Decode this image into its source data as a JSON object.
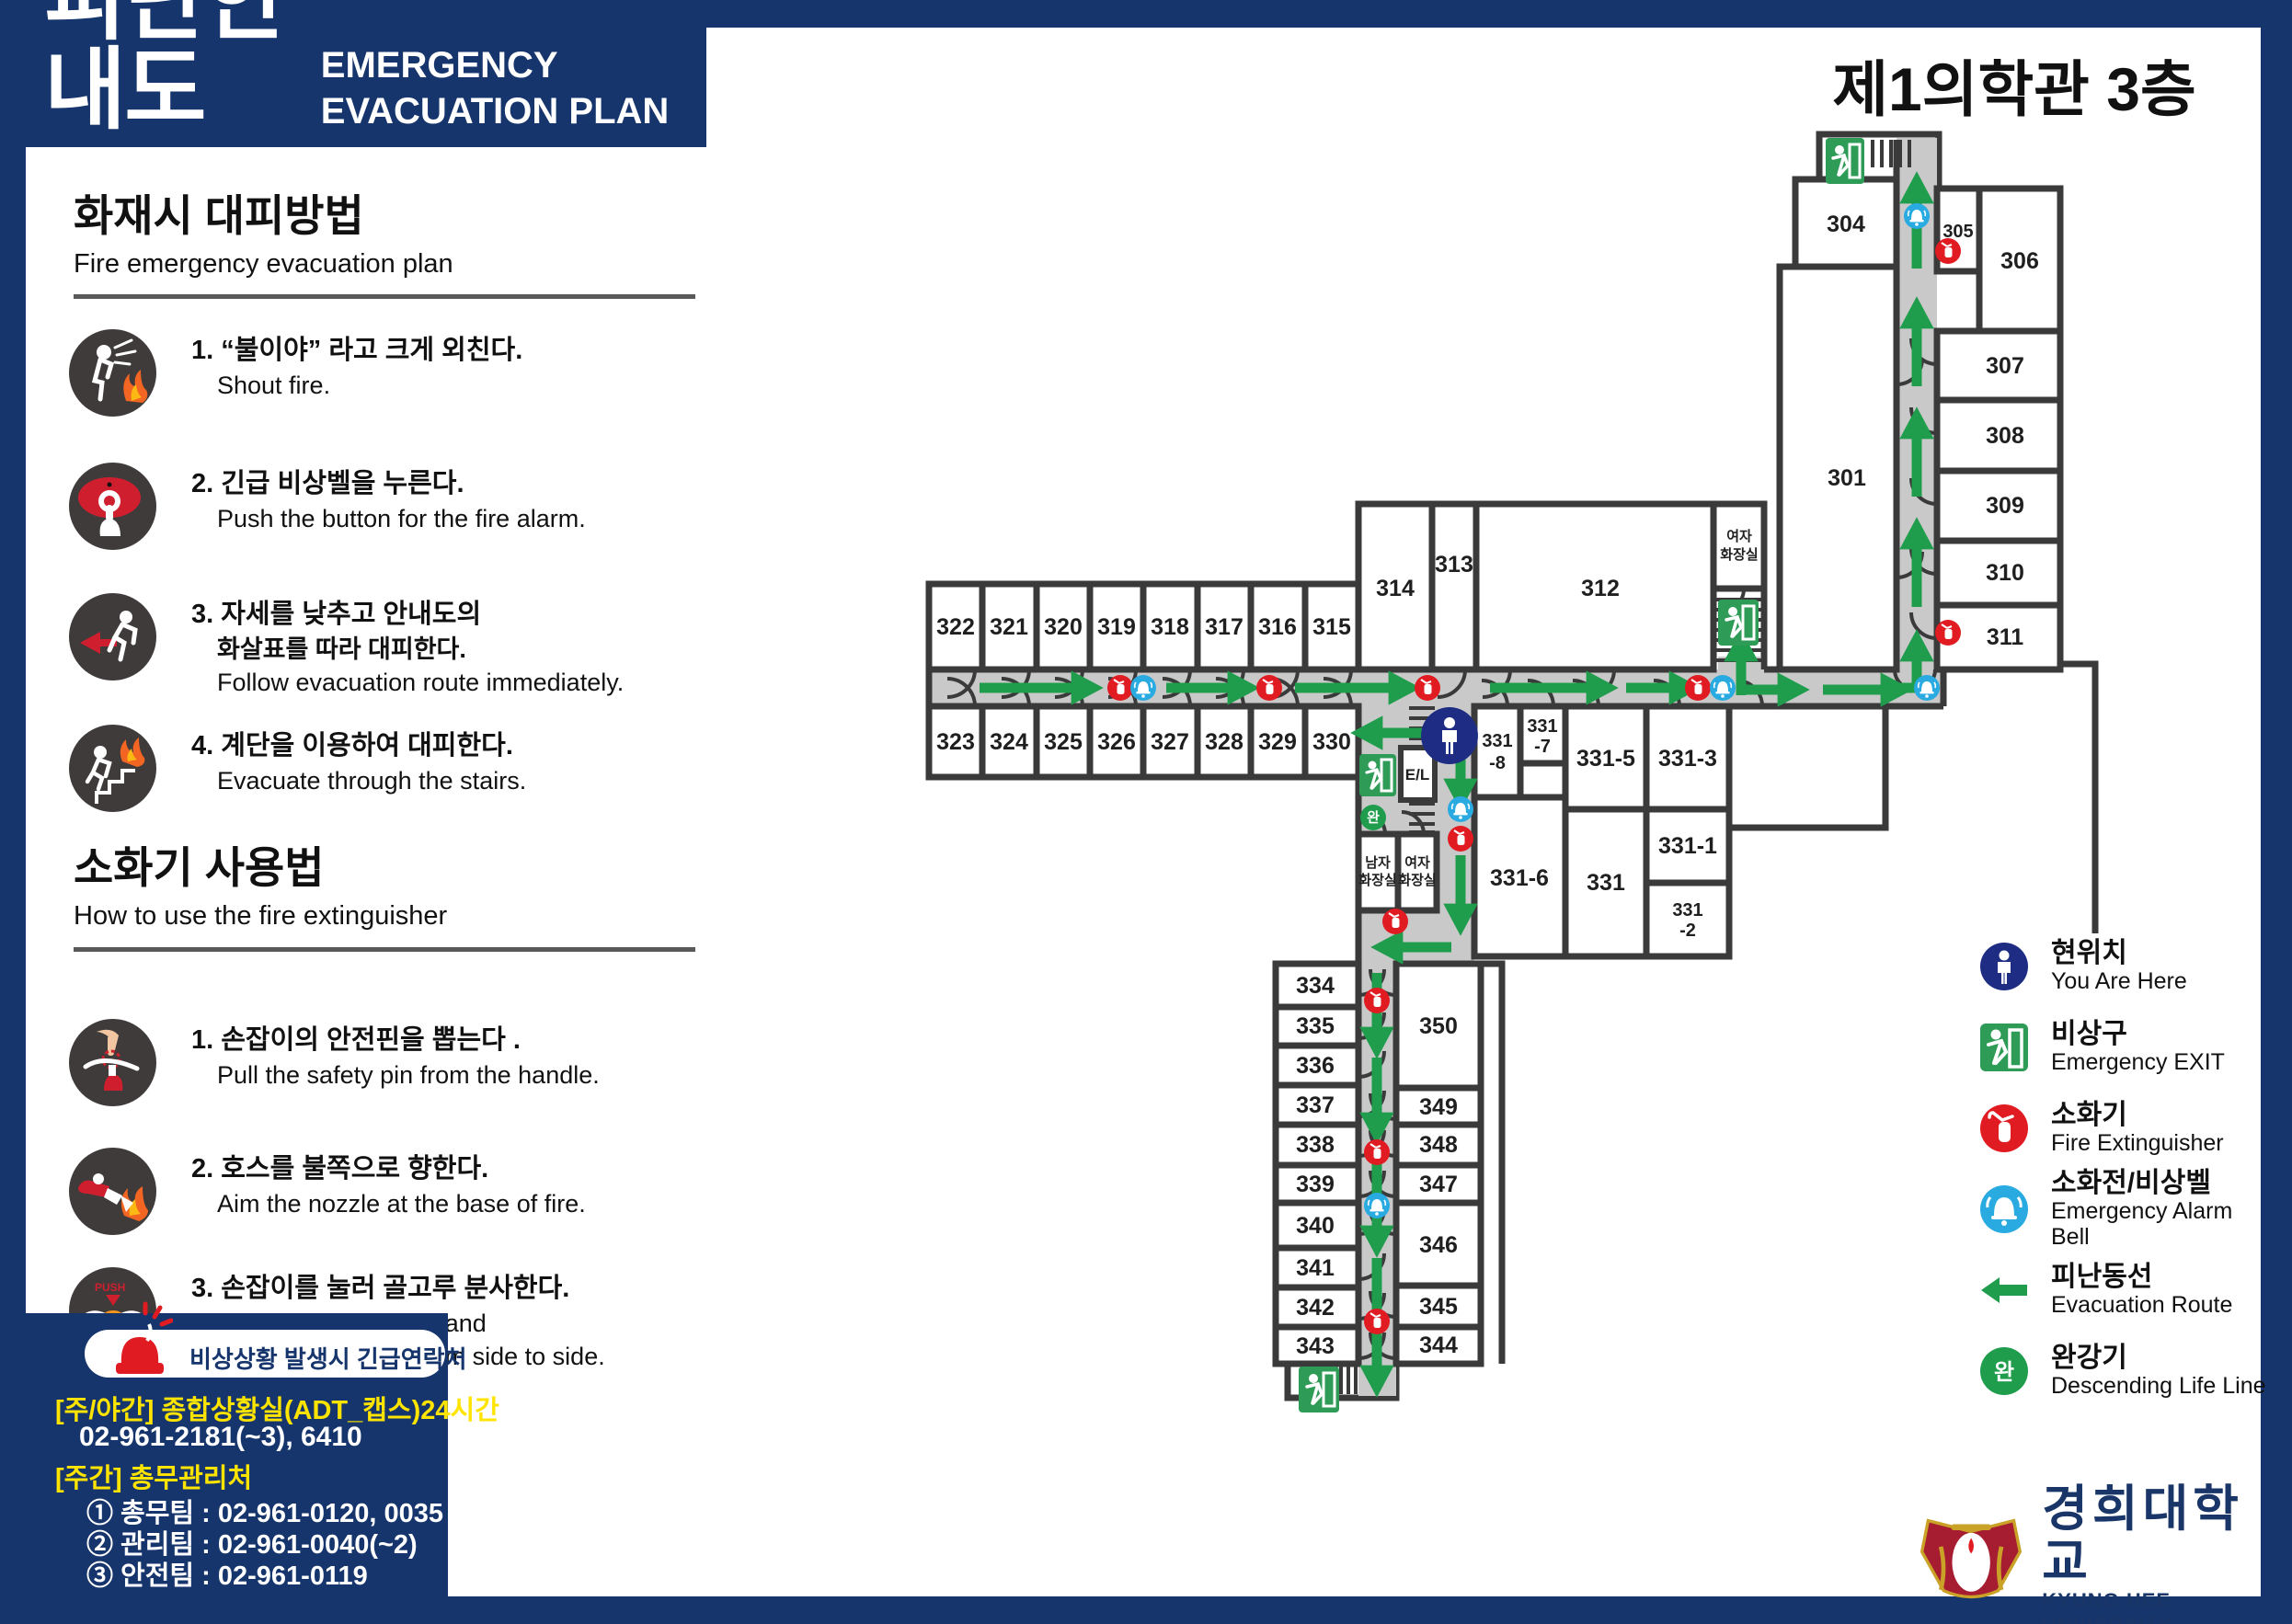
{
  "header": {
    "title_ko": "피난안내도",
    "title_en": "EMERGENCY EVACUATION PLAN",
    "building": "제1의학관 3층"
  },
  "fire_evacuation": {
    "title_ko": "화재시 대피방법",
    "title_en": "Fire emergency evacuation plan",
    "steps": [
      {
        "ko": "1. “불이야” 라고 크게 외친다.",
        "en": "Shout fire."
      },
      {
        "ko": "2. 긴급 비상벨을 누른다.",
        "en": "Push the button for the fire alarm."
      },
      {
        "ko": "3. 자세를 낮추고 안내도의",
        "ko2": "화살표를 따라 대피한다.",
        "en": "Follow evacuation route immediately."
      },
      {
        "ko": "4. 계단을 이용하여 대피한다.",
        "en": "Evacuate through the stairs."
      }
    ]
  },
  "extinguisher_usage": {
    "title_ko": "소화기 사용법",
    "title_en": "How to use the fire extinguisher",
    "steps": [
      {
        "ko": "1. 손잡이의 안전핀을 뽑는다 .",
        "en": "Pull the safety pin from the handle."
      },
      {
        "ko": "2. 호스를 불쪽으로 향한다.",
        "en": "Aim the nozzle at the base of fire."
      },
      {
        "ko": "3. 손잡이를 눌러 골고루 분사한다.",
        "en": "Squeeze the handle and",
        "en2": "sweep the nozzle from side to side."
      }
    ]
  },
  "emergency_contact": {
    "title": "비상상황 발생시 긴급연락처",
    "line1": "[주/야간] 종합상황실(ADT_캡스)24시간",
    "line1_phone": "02-961-2181(~3), 6410",
    "line2": "[주간] 총무관리처",
    "team_lines": [
      "① 총무팀 : 02-961-0120, 0035",
      "② 관리팀 : 02-961-0040(~2)",
      "③ 안전팀 : 02-961-0119"
    ]
  },
  "legend": {
    "items": [
      {
        "ko": "현위치",
        "en": "You Are Here",
        "icon": "you-are-here-icon"
      },
      {
        "ko": "비상구",
        "en": "Emergency EXIT",
        "icon": "emergency-exit-icon"
      },
      {
        "ko": "소화기",
        "en": "Fire Extinguisher",
        "icon": "fire-extinguisher-icon"
      },
      {
        "ko": "소화전/비상벨",
        "en": "Emergency Alarm Bell",
        "icon": "alarm-bell-icon"
      },
      {
        "ko": "피난동선",
        "en": "Evacuation Route",
        "icon": "evacuation-route-icon"
      },
      {
        "ko": "완강기",
        "en": "Descending Life Line",
        "icon": "descending-life-line-icon"
      }
    ]
  },
  "plan": {
    "rooms": {
      "r301": "301",
      "r304": "304",
      "r305": "305",
      "r306": "306",
      "r307": "307",
      "r308": "308",
      "r309": "309",
      "r310": "310",
      "r311": "311",
      "r312": "312",
      "r313": "313",
      "r314": "314",
      "r315": "315",
      "r316": "316",
      "r317": "317",
      "r318": "318",
      "r319": "319",
      "r320": "320",
      "r321": "321",
      "r322": "322",
      "r323": "323",
      "r324": "324",
      "r325": "325",
      "r326": "326",
      "r327": "327",
      "r328": "328",
      "r329": "329",
      "r330": "330",
      "r331": "331",
      "r331_1": "331-1",
      "r331_2a": "331",
      "r331_2b": "-2",
      "r331_3": "331-3",
      "r331_5": "331-5",
      "r331_6": "331-6",
      "r331_7a": "331",
      "r331_7b": "-7",
      "r331_8a": "331",
      "r331_8b": "-8",
      "r334": "334",
      "r335": "335",
      "r336": "336",
      "r337": "337",
      "r338": "338",
      "r339": "339",
      "r340": "340",
      "r341": "341",
      "r342": "342",
      "r343": "343",
      "r344": "344",
      "r345": "345",
      "r346": "346",
      "r347": "347",
      "r348": "348",
      "r349": "349",
      "r350": "350"
    },
    "labels": {
      "el": "E/L",
      "wan": "완",
      "men1": "남자",
      "men2": "화장실",
      "women1": "여자",
      "women2": "화장실",
      "womenN1": "여자",
      "womenN2": "화장실"
    }
  },
  "logo": {
    "ko": "경희대학교",
    "en": "KYUNG HEE UNIVERSITY"
  },
  "colors": {
    "navy": "#16356c",
    "wall": "#3a3a3a",
    "corridor": "#c9c9c9",
    "route_green": "#1f9d4d",
    "exit_green": "#2e9b57",
    "extinguisher_red": "#e11b22",
    "alarm_blue": "#29abe2",
    "you_are_here_navy": "#1e2d83",
    "contact_yellow": "#ffe400"
  }
}
